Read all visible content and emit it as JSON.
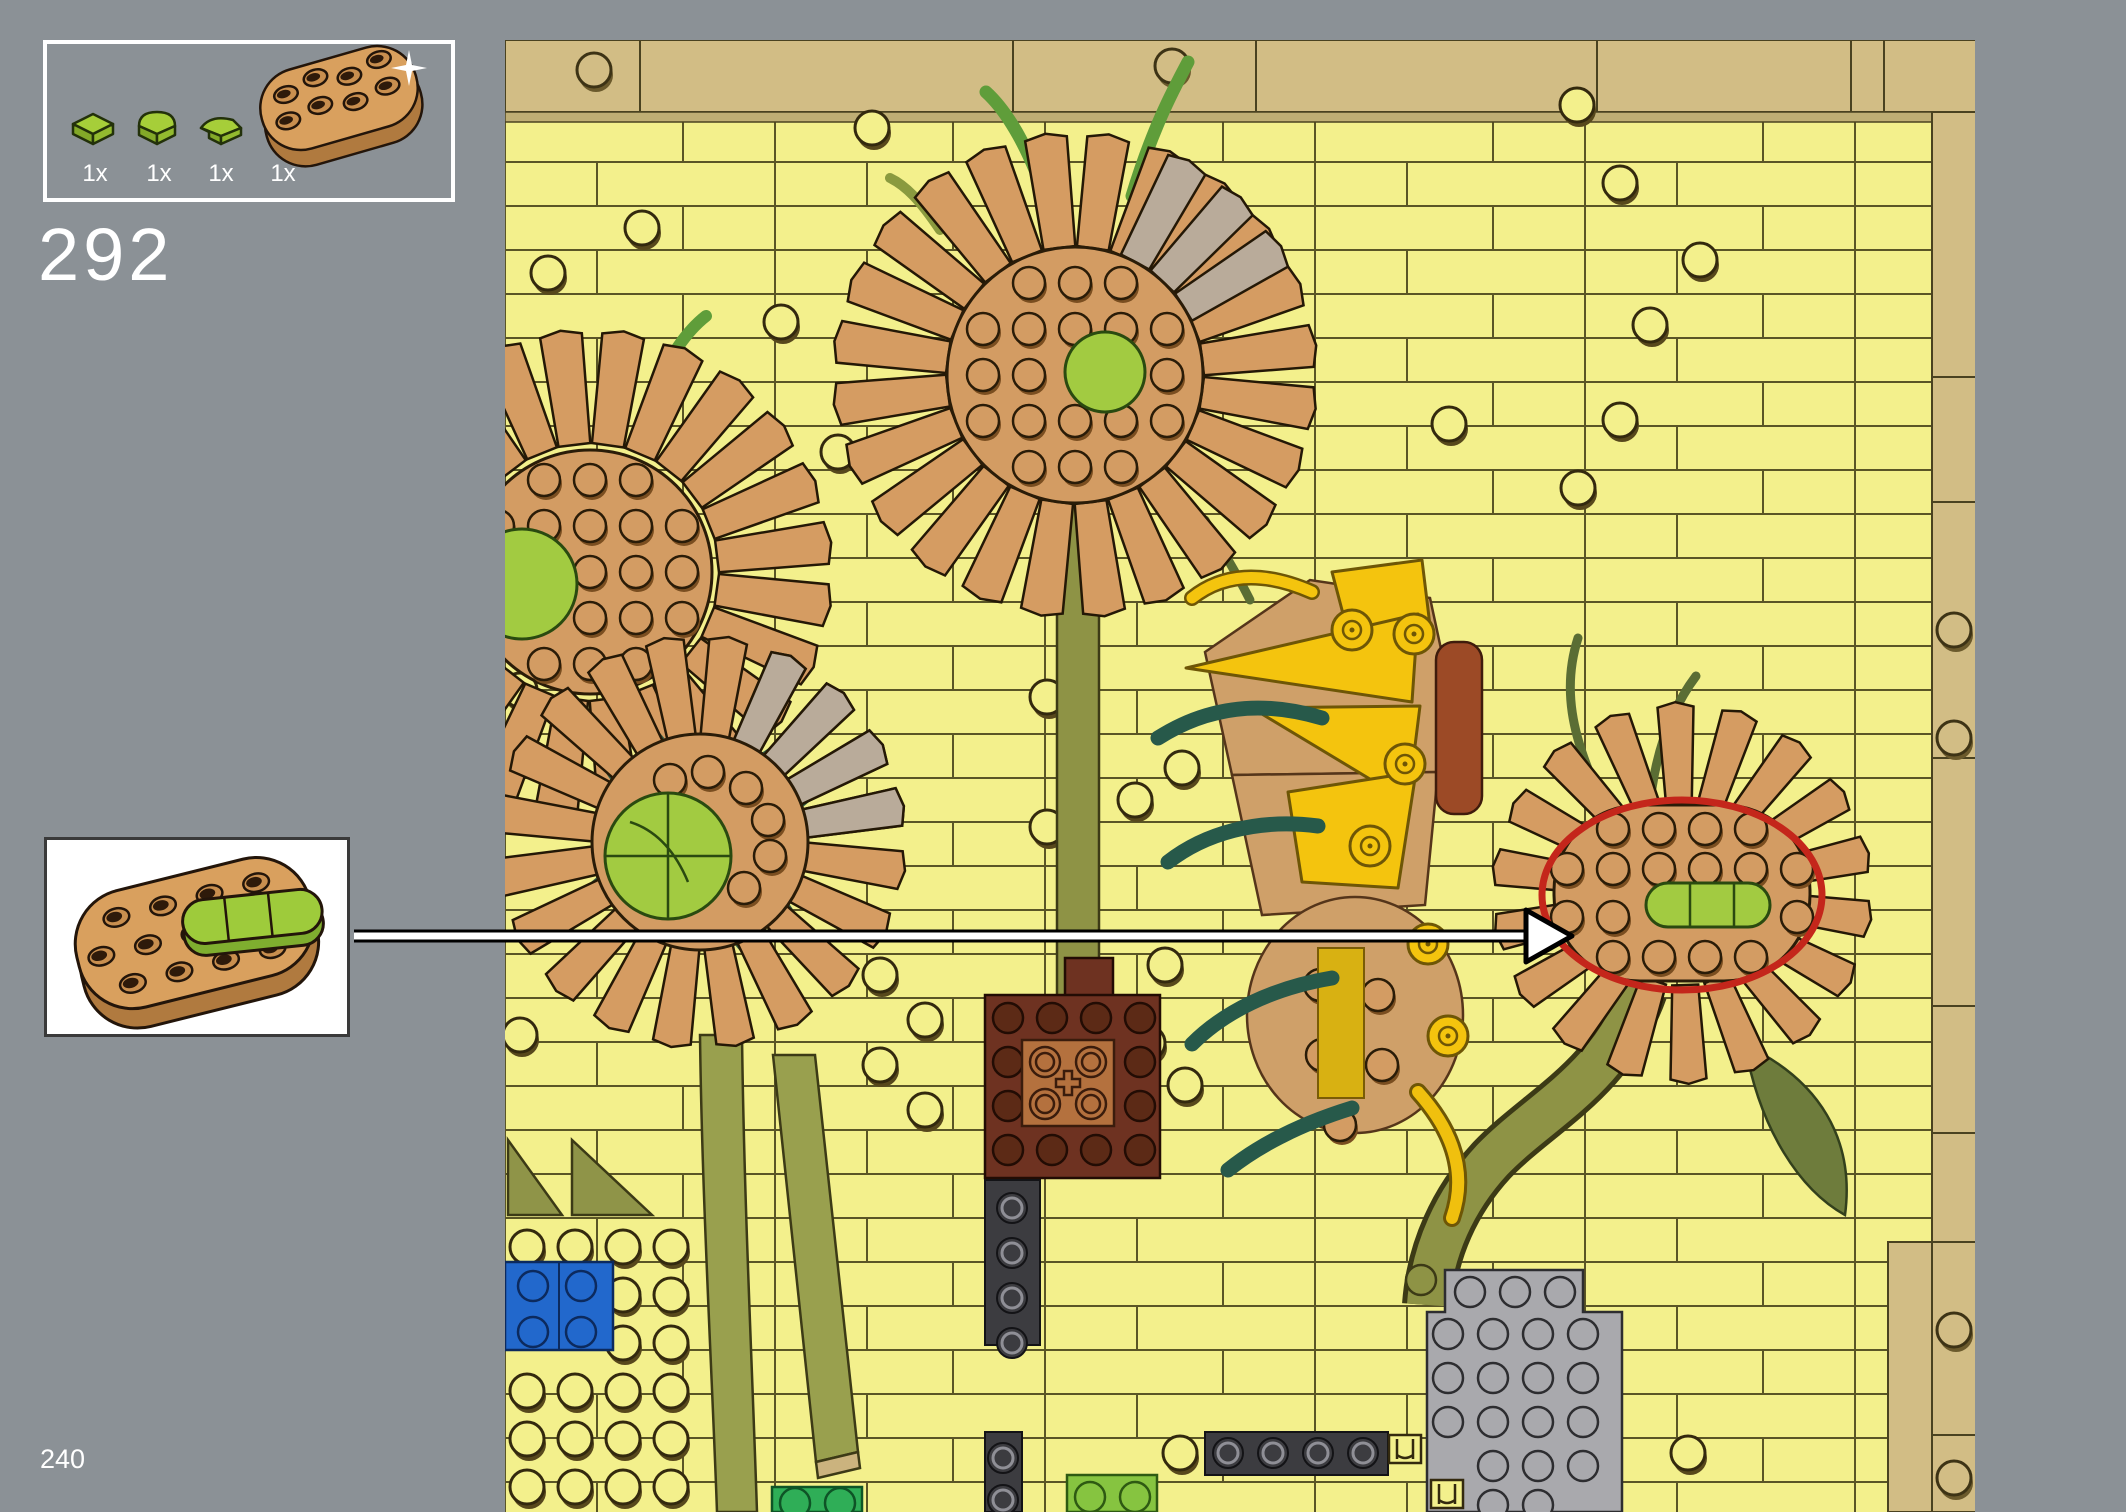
{
  "page": {
    "step_number": "292",
    "page_number": "240"
  },
  "parts_callout": {
    "items": [
      {
        "qty": "1x",
        "part_name": "plate-1x1-lime"
      },
      {
        "qty": "1x",
        "part_name": "tile-1x1-half-round-lime"
      },
      {
        "qty": "1x",
        "part_name": "tile-1x1-quarter-round-lime"
      },
      {
        "qty": "1x",
        "part_name": "plate-oval-nougat",
        "badge": "new-part-sparkle"
      }
    ]
  },
  "inset_preview": {
    "description": "oval nougat plate sub-assembly with lime rounded tiles on top"
  },
  "callout": {
    "arrow": "white-arrow-right",
    "from": "subassembly-inset",
    "to": "red-oval-highlight on right sunflower head"
  },
  "build": {
    "subject": "LEGO sunflowers mosaic section",
    "flower_heads": 5
  },
  "colors": {
    "background": "#8b9196",
    "mosaic_yellow": "#f3f08c",
    "border_tan": "#d2bd85",
    "petal_nougat": "#d59c62",
    "petal_gray": "#b9ab9a",
    "lime_green": "#a2cb41",
    "olive_stem": "#939a4c",
    "dark_green": "#27594a",
    "bright_yellow": "#f4c40e",
    "reddish_brown": "#6e3221",
    "medium_nougat": "#b4713e",
    "blue": "#2268cc",
    "dark_gray": "#3c3c40",
    "light_gray": "#a9a9ad",
    "bright_green": "#2fae57",
    "highlight_red": "#c4261b"
  }
}
